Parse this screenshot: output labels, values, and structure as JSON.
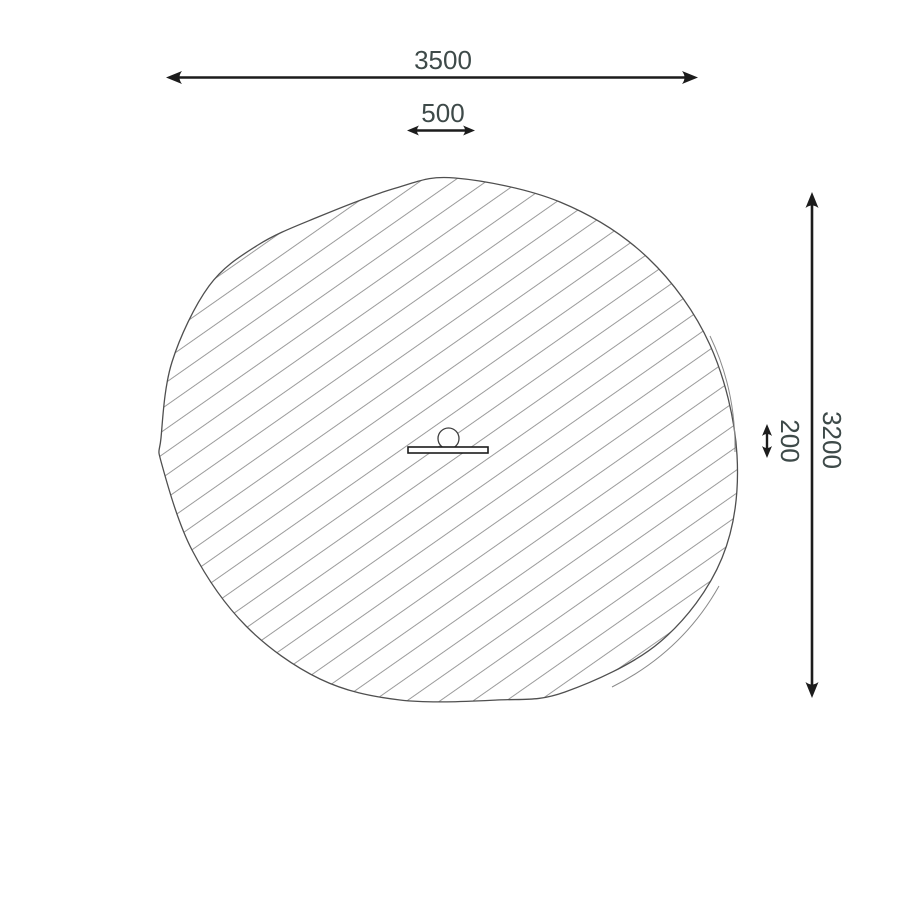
{
  "drawing": {
    "kind": "plan-view dimension drawing",
    "dimensions": {
      "overall_width": "3500",
      "equipment_width": "500",
      "overall_height": "3200",
      "equipment_depth": "200"
    },
    "colors": {
      "background": "#ffffff",
      "arrow": "#1c1c1c",
      "dimension_text": "#3e4a49",
      "hatch_line": "#9b9b9b",
      "region_outline": "#4f4f4f"
    },
    "icons": {
      "hatched_region": "safety-zone-hatched-region",
      "equipment_symbol": "equipment-plan-symbol"
    }
  }
}
